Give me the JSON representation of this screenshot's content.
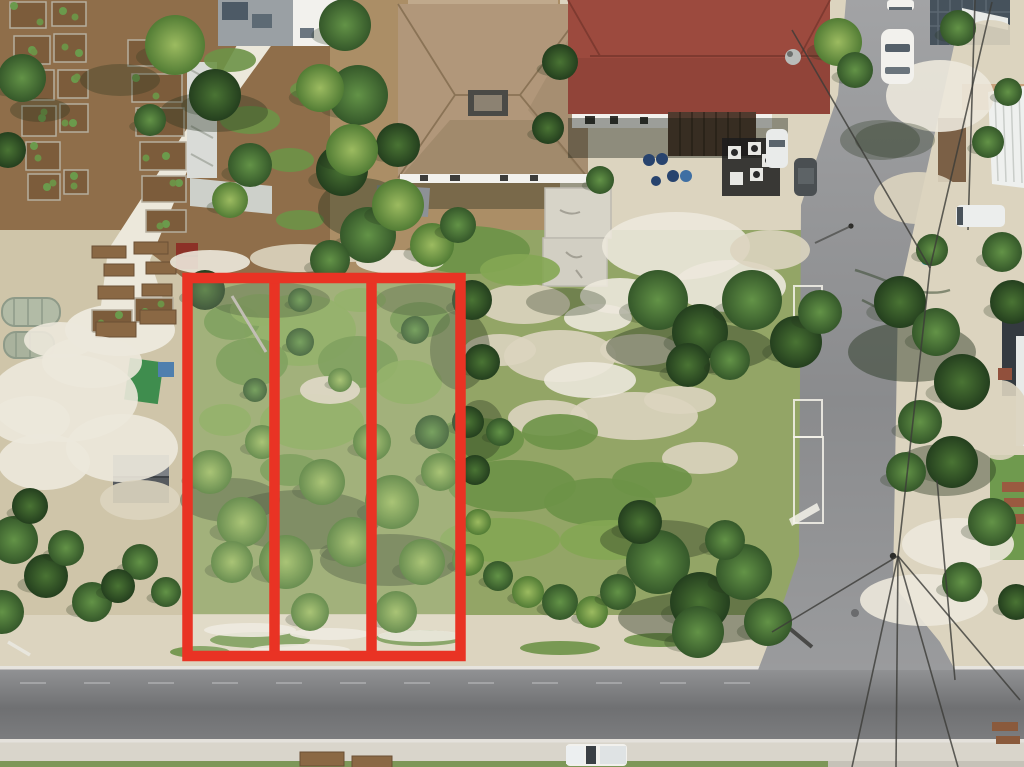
{
  "scene": {
    "type": "aerial-drone-photograph",
    "description": "Overhead drone photo of a vacant treed parcel split into three lots outlined in red, beside a community garden, residential buildings with red and tan roofs, a T-intersection of two gray asphalt streets, parked white vehicles and utility lines.",
    "width": 1024,
    "height": 767
  },
  "palette": {
    "sandBase": "#cfc5a9",
    "sandBright": "#ece8db",
    "sandPale": "#dcd4bf",
    "dirtGarden": "#8f6e4a",
    "dirtYard": "#ab8e66",
    "grassField": "#93a566",
    "grassDark": "#6d9247",
    "grassBright": "#84a653",
    "grassStrip": "#7d9758",
    "treeDark": "#2e5229",
    "treeMid": "#47743a",
    "treeLight": "#6b9a4c",
    "asphaltLight": "#9b9c9e",
    "asphaltDark": "#717274",
    "apron": "#d9d5cb",
    "whiteLine": "#efece5",
    "roofRed": "#9c4a3e",
    "roofRedDark": "#7e3a30",
    "roofTan": "#b1977a",
    "roofTanLight": "#c0a98c",
    "roofTanDark": "#8f7a5c",
    "roofGray": "#9aa0a4",
    "white": "#f2f1ed",
    "bedSoil": "#7c5c3b",
    "bedEdge": "#b5ae9e",
    "woodTable": "#8a6844",
    "shedDarkRoof": "#565a5e",
    "redShed": "#8c3127",
    "tarpGreen": "#3f8d4e",
    "tarpBlue": "#4f7fae",
    "barrelBlue": "#27436e",
    "kayakTeal": "#2e9aa6",
    "wire": "#3c3c38",
    "shadowGreen": "#24321c",
    "darkBuilding": "#46525c"
  },
  "annotation": {
    "color": "#e93324",
    "stroke_width": 10.5,
    "outer": {
      "x": 187.5,
      "y": 278,
      "width": 273,
      "height": 378
    },
    "divider_x": [
      274.5,
      371.5
    ],
    "lot_count": 3,
    "haze_opacity": 0.14
  },
  "garden": {
    "beds": [
      [
        10,
        2,
        36,
        26
      ],
      [
        52,
        2,
        34,
        24
      ],
      [
        14,
        36,
        36,
        28
      ],
      [
        54,
        34,
        32,
        28
      ],
      [
        18,
        70,
        36,
        30
      ],
      [
        58,
        70,
        30,
        28
      ],
      [
        22,
        106,
        34,
        30
      ],
      [
        60,
        104,
        28,
        28
      ],
      [
        26,
        142,
        34,
        28
      ],
      [
        28,
        174,
        32,
        26
      ],
      [
        64,
        170,
        24,
        24
      ],
      [
        128,
        40,
        54,
        26
      ],
      [
        132,
        74,
        50,
        28
      ],
      [
        136,
        108,
        48,
        28
      ],
      [
        140,
        142,
        46,
        28
      ],
      [
        142,
        176,
        44,
        26
      ],
      [
        146,
        210,
        40,
        22
      ],
      [
        92,
        310,
        40,
        22
      ],
      [
        135,
        298,
        38,
        24
      ],
      [
        413,
        52,
        36,
        24
      ],
      [
        455,
        60,
        34,
        22
      ],
      [
        420,
        86,
        32,
        20
      ]
    ],
    "tables": [
      [
        92,
        246,
        34,
        12
      ],
      [
        134,
        242,
        34,
        12
      ],
      [
        104,
        264,
        30,
        12
      ],
      [
        146,
        262,
        30,
        12
      ],
      [
        98,
        286,
        36,
        13
      ],
      [
        142,
        284,
        30,
        12
      ],
      [
        96,
        322,
        40,
        15
      ],
      [
        140,
        310,
        36,
        14
      ],
      [
        300,
        752,
        44,
        14
      ],
      [
        352,
        756,
        40,
        12
      ]
    ]
  },
  "trees": [
    [
      22,
      78,
      24,
      "m"
    ],
    [
      8,
      150,
      18,
      "d"
    ],
    [
      175,
      45,
      30,
      "l"
    ],
    [
      215,
      95,
      26,
      "d"
    ],
    [
      150,
      120,
      16,
      "m"
    ],
    [
      250,
      165,
      22,
      "m"
    ],
    [
      230,
      200,
      18,
      "l"
    ],
    [
      345,
      25,
      26,
      "m"
    ],
    [
      358,
      95,
      30,
      "m"
    ],
    [
      342,
      170,
      26,
      "d"
    ],
    [
      368,
      235,
      28,
      "m"
    ],
    [
      398,
      145,
      22,
      "d"
    ],
    [
      330,
      260,
      20,
      "m"
    ],
    [
      320,
      88,
      24,
      "l"
    ],
    [
      352,
      150,
      26,
      "l"
    ],
    [
      398,
      205,
      26,
      "l"
    ],
    [
      432,
      245,
      22,
      "l"
    ],
    [
      458,
      225,
      18,
      "m"
    ],
    [
      560,
      62,
      18,
      "d"
    ],
    [
      548,
      128,
      16,
      "d"
    ],
    [
      600,
      180,
      14,
      "m"
    ],
    [
      658,
      300,
      30,
      "m"
    ],
    [
      700,
      332,
      28,
      "d"
    ],
    [
      752,
      300,
      30,
      "m"
    ],
    [
      796,
      342,
      26,
      "d"
    ],
    [
      820,
      312,
      22,
      "m"
    ],
    [
      688,
      365,
      22,
      "d"
    ],
    [
      730,
      360,
      20,
      "m"
    ],
    [
      658,
      562,
      32,
      "m"
    ],
    [
      700,
      602,
      30,
      "d"
    ],
    [
      744,
      572,
      28,
      "m"
    ],
    [
      698,
      632,
      26,
      "m"
    ],
    [
      640,
      522,
      22,
      "d"
    ],
    [
      768,
      622,
      24,
      "m"
    ],
    [
      725,
      540,
      20,
      "m"
    ],
    [
      468,
      560,
      16,
      "l"
    ],
    [
      498,
      576,
      15,
      "m"
    ],
    [
      528,
      592,
      16,
      "l"
    ],
    [
      560,
      602,
      18,
      "m"
    ],
    [
      592,
      612,
      16,
      "l"
    ],
    [
      618,
      592,
      18,
      "m"
    ],
    [
      478,
      522,
      13,
      "l"
    ],
    [
      472,
      300,
      20,
      "d"
    ],
    [
      482,
      362,
      18,
      "d"
    ],
    [
      468,
      422,
      16,
      "d"
    ],
    [
      500,
      432,
      14,
      "m"
    ],
    [
      475,
      470,
      15,
      "d"
    ],
    [
      838,
      42,
      24,
      "l"
    ],
    [
      855,
      70,
      18,
      "m"
    ],
    [
      958,
      28,
      18,
      "m"
    ],
    [
      900,
      302,
      26,
      "d"
    ],
    [
      936,
      332,
      24,
      "m"
    ],
    [
      962,
      382,
      28,
      "d"
    ],
    [
      920,
      422,
      22,
      "m"
    ],
    [
      952,
      462,
      26,
      "d"
    ],
    [
      906,
      472,
      20,
      "m"
    ],
    [
      988,
      142,
      16,
      "m"
    ],
    [
      1002,
      252,
      20,
      "m"
    ],
    [
      1012,
      302,
      22,
      "d"
    ],
    [
      992,
      522,
      24,
      "m"
    ],
    [
      962,
      582,
      20,
      "m"
    ],
    [
      1016,
      602,
      18,
      "d"
    ],
    [
      1008,
      92,
      14,
      "m"
    ],
    [
      932,
      250,
      16,
      "m"
    ],
    [
      14,
      540,
      24,
      "m"
    ],
    [
      46,
      576,
      22,
      "d"
    ],
    [
      92,
      602,
      20,
      "m"
    ],
    [
      140,
      562,
      18,
      "m"
    ],
    [
      30,
      506,
      18,
      "d"
    ],
    [
      2,
      612,
      22,
      "m"
    ],
    [
      166,
      592,
      15,
      "m"
    ],
    [
      118,
      586,
      17,
      "d"
    ],
    [
      66,
      548,
      18,
      "m"
    ],
    [
      210,
      472,
      22,
      "l"
    ],
    [
      242,
      522,
      25,
      "l"
    ],
    [
      286,
      562,
      27,
      "l"
    ],
    [
      322,
      482,
      23,
      "l"
    ],
    [
      352,
      542,
      25,
      "l"
    ],
    [
      392,
      502,
      27,
      "l"
    ],
    [
      422,
      562,
      23,
      "l"
    ],
    [
      440,
      472,
      19,
      "l"
    ],
    [
      232,
      562,
      21,
      "l"
    ],
    [
      310,
      612,
      19,
      "l"
    ],
    [
      396,
      612,
      21,
      "l"
    ],
    [
      262,
      442,
      17,
      "l"
    ],
    [
      372,
      442,
      19,
      "l"
    ],
    [
      432,
      432,
      17,
      "m"
    ],
    [
      205,
      290,
      20,
      "d"
    ],
    [
      300,
      342,
      14,
      "m"
    ],
    [
      255,
      390,
      12,
      "m"
    ],
    [
      340,
      380,
      12,
      "l"
    ],
    [
      415,
      330,
      14,
      "m"
    ],
    [
      300,
      300,
      12,
      "m"
    ]
  ],
  "patches": [
    [
      560,
      356,
      56,
      26,
      "sandPale"
    ],
    [
      634,
      416,
      64,
      24,
      "sandPale"
    ],
    [
      524,
      304,
      46,
      20,
      "sandPale"
    ],
    [
      700,
      458,
      38,
      16,
      "sandPale"
    ],
    [
      598,
      318,
      34,
      14,
      "sandBright"
    ],
    [
      548,
      418,
      40,
      18,
      "sandPale"
    ],
    [
      500,
      350,
      36,
      16,
      "sandPale"
    ],
    [
      640,
      350,
      40,
      16,
      "sandPale"
    ],
    [
      590,
      380,
      46,
      18,
      "sandBright"
    ],
    [
      680,
      400,
      36,
      14,
      "sandPale"
    ],
    [
      512,
      486,
      64,
      26,
      "grassDark"
    ],
    [
      600,
      502,
      56,
      24,
      "grassDark"
    ],
    [
      478,
      440,
      46,
      22,
      "grassDark"
    ],
    [
      560,
      432,
      38,
      18,
      "grassDark"
    ],
    [
      652,
      480,
      40,
      18,
      "grassDark"
    ],
    [
      500,
      540,
      60,
      22,
      "grassBright"
    ],
    [
      610,
      540,
      50,
      20,
      "grassBright"
    ],
    [
      470,
      250,
      60,
      24,
      "grassDark"
    ],
    [
      520,
      270,
      40,
      16,
      "grassBright"
    ],
    [
      64,
      398,
      74,
      44,
      "sandBright"
    ],
    [
      122,
      448,
      56,
      34,
      "sandBright"
    ],
    [
      44,
      462,
      46,
      28,
      "sandBright"
    ],
    [
      92,
      362,
      50,
      26,
      "sandBright"
    ],
    [
      30,
      420,
      40,
      24,
      "sandBright"
    ],
    [
      140,
      500,
      40,
      20,
      "sandPale"
    ],
    [
      60,
      340,
      36,
      18,
      "sandBright"
    ],
    [
      210,
      262,
      40,
      12,
      "sandBright"
    ],
    [
      300,
      258,
      50,
      14,
      "sandPale"
    ],
    [
      400,
      262,
      44,
      12,
      "sandBright"
    ],
    [
      350,
      252,
      30,
      10,
      "sandPale"
    ],
    [
      940,
      96,
      54,
      36,
      "sandBright"
    ],
    [
      918,
      198,
      44,
      26,
      "sandPale"
    ],
    [
      958,
      544,
      56,
      26,
      "sandBright"
    ],
    [
      924,
      600,
      64,
      26,
      "sandBright"
    ],
    [
      1000,
      420,
      30,
      40,
      "sandPale"
    ],
    [
      990,
      40,
      30,
      20,
      "sandPale"
    ],
    [
      300,
      330,
      56,
      36,
      "grassBright"
    ],
    [
      252,
      362,
      36,
      24,
      "grassDark"
    ],
    [
      358,
      362,
      40,
      26,
      "grassDark"
    ],
    [
      312,
      422,
      52,
      28,
      "grassBright"
    ],
    [
      232,
      322,
      28,
      18,
      "grassDark"
    ],
    [
      408,
      382,
      34,
      22,
      "grassBright"
    ],
    [
      260,
      310,
      30,
      16,
      "grassBright"
    ],
    [
      420,
      320,
      30,
      18,
      "grassDark"
    ],
    [
      225,
      420,
      26,
      16,
      "grassBright"
    ],
    [
      330,
      390,
      30,
      14,
      "sandPale"
    ],
    [
      290,
      470,
      30,
      16,
      "grassDark"
    ],
    [
      360,
      300,
      26,
      12,
      "grassBright"
    ],
    [
      260,
      640,
      50,
      8,
      "grassDark"
    ],
    [
      420,
      638,
      44,
      8,
      "grassDark"
    ],
    [
      560,
      648,
      40,
      7,
      "grassDark"
    ],
    [
      660,
      640,
      36,
      7,
      "grassDark"
    ],
    [
      200,
      652,
      30,
      6,
      "grassDark"
    ],
    [
      250,
      630,
      46,
      7,
      "sandBright"
    ],
    [
      330,
      634,
      40,
      6,
      "sandBright"
    ],
    [
      420,
      636,
      42,
      6,
      "sandBright"
    ],
    [
      300,
      650,
      50,
      6,
      "sandBright"
    ],
    [
      676,
      246,
      74,
      34,
      "sandBright"
    ],
    [
      730,
      286,
      56,
      26,
      "sandBright"
    ],
    [
      620,
      296,
      40,
      18,
      "sandBright"
    ],
    [
      770,
      250,
      40,
      20,
      "sandPale"
    ],
    [
      250,
      120,
      30,
      14,
      "grassDark"
    ],
    [
      290,
      160,
      24,
      12,
      "grassDark"
    ],
    [
      230,
      60,
      26,
      12,
      "grassDark"
    ],
    [
      300,
      220,
      24,
      10,
      "grassDark"
    ],
    [
      310,
      90,
      20,
      10,
      "grassDark"
    ]
  ],
  "shadows": [
    [
      690,
      348,
      84,
      26,
      0.4
    ],
    [
      702,
      618,
      84,
      26,
      0.4
    ],
    [
      566,
      302,
      40,
      14,
      0.3
    ],
    [
      214,
      112,
      54,
      20,
      0.35
    ],
    [
      362,
      208,
      44,
      30,
      0.4
    ],
    [
      912,
      352,
      64,
      30,
      0.45
    ],
    [
      944,
      470,
      52,
      26,
      0.4
    ],
    [
      270,
      300,
      60,
      18,
      0.3
    ],
    [
      420,
      300,
      44,
      16,
      0.3
    ],
    [
      660,
      540,
      60,
      20,
      0.35
    ],
    [
      120,
      80,
      40,
      16,
      0.3
    ],
    [
      40,
      110,
      30,
      12,
      0.3
    ],
    [
      895,
      140,
      40,
      18,
      0.3
    ],
    [
      300,
      520,
      80,
      30,
      0.35
    ],
    [
      390,
      560,
      70,
      26,
      0.35
    ],
    [
      230,
      500,
      50,
      22,
      0.35
    ],
    [
      460,
      350,
      30,
      40,
      0.35
    ],
    [
      480,
      430,
      24,
      30,
      0.35
    ],
    [
      880,
      140,
      40,
      20,
      0.3
    ]
  ],
  "power_lines": [
    [
      792,
      30,
      930,
      268
    ],
    [
      992,
      2,
      930,
      268
    ],
    [
      930,
      268,
      898,
      556
    ],
    [
      898,
      556,
      1020,
      700
    ],
    [
      898,
      556,
      958,
      767
    ],
    [
      898,
      556,
      852,
      767
    ],
    [
      898,
      556,
      772,
      632
    ],
    [
      975,
      0,
      968,
      230
    ],
    [
      898,
      556,
      896,
      767
    ],
    [
      937,
      480,
      955,
      680
    ]
  ],
  "parking_stalls": [
    [
      794,
      286,
      28,
      38
    ],
    [
      794,
      400,
      28,
      37
    ],
    [
      794,
      437,
      29,
      86
    ]
  ],
  "vehicles": {
    "car_top_road": "white car parked on north street",
    "car_top_edge": "white car at top edge",
    "car_by_building": "white car beside red-roof building",
    "dark_car_by_building": "dark car beside red-roof building",
    "van_right": "white van in right-side driveway",
    "pickup_bottom": "white pickup truck on south street shoulder"
  }
}
